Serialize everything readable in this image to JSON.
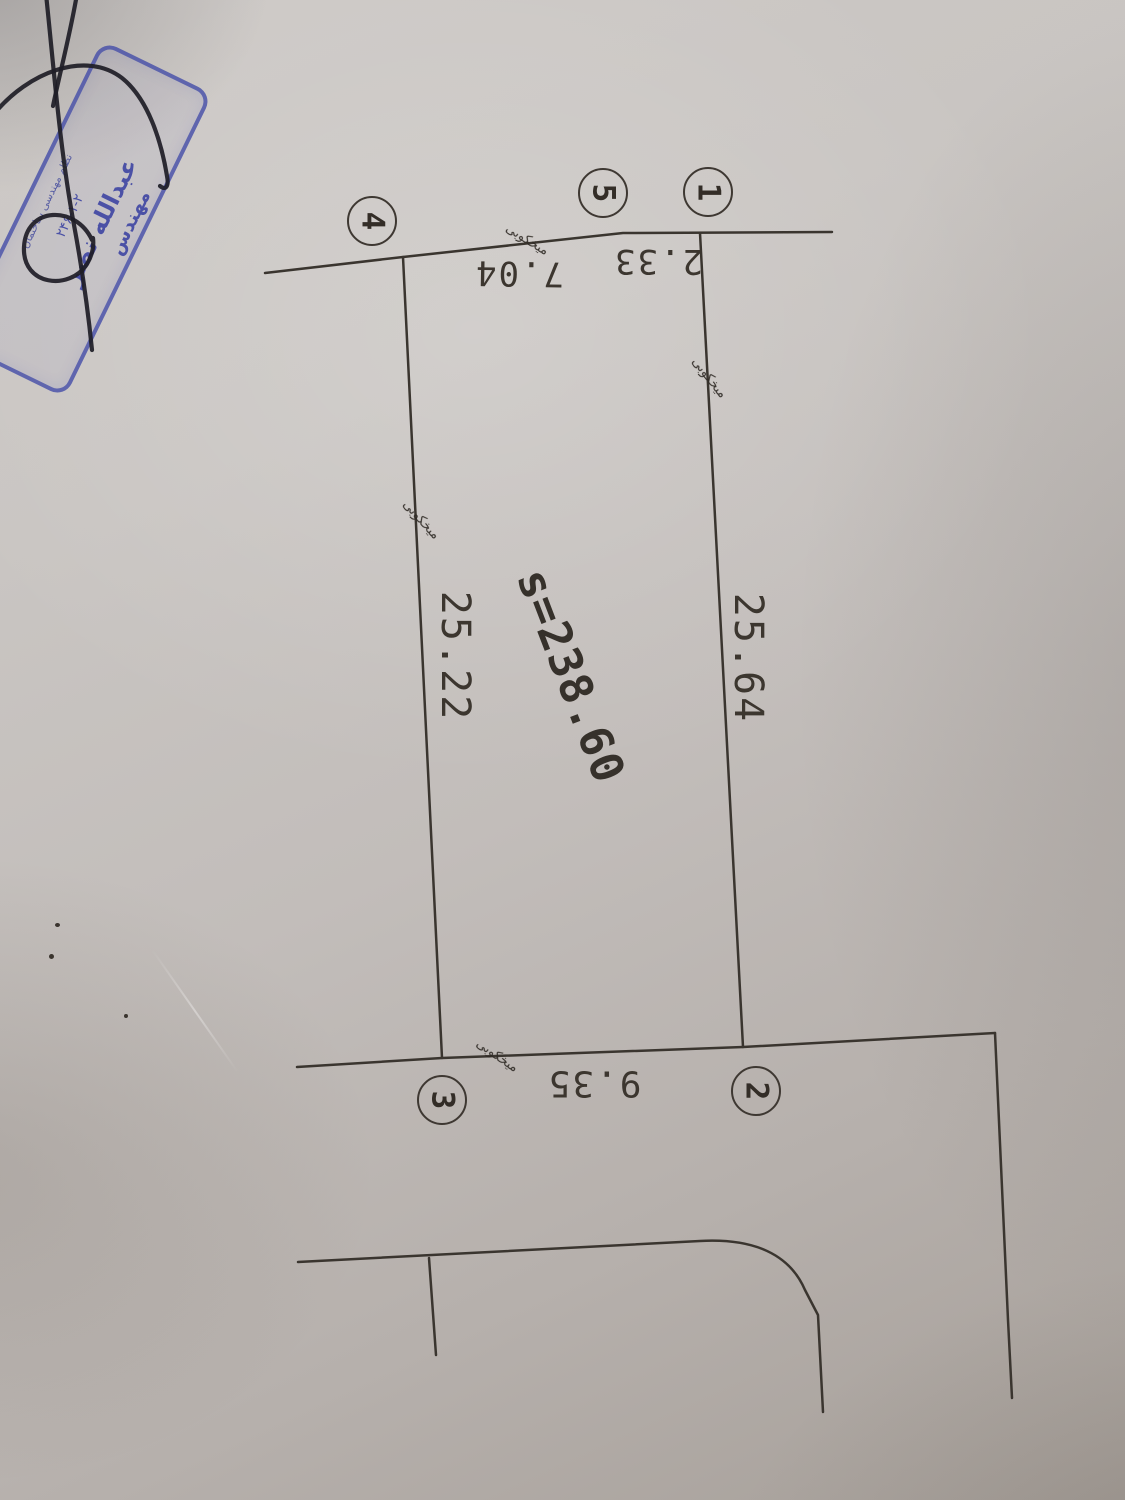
{
  "stamp": {
    "org_line": "نظام مهندسی ساختمان",
    "license_line": "۲۴۶-۱-۲",
    "name_line": "عبدالله نصر",
    "title_line": "مهندس",
    "color": "#4b51a6"
  },
  "plot": {
    "area_label": "s=238.60",
    "point_labels": [
      "1",
      "2",
      "3",
      "4",
      "5"
    ],
    "dimensions": {
      "right_side": "25.64",
      "left_side": "25.22",
      "top_seg_1_5": "2.33",
      "top_seg_5_4": "7.04",
      "bottom_seg_3_2": "9.35"
    },
    "annotation_text": "میخکوبی"
  },
  "colors": {
    "paper": "#c6c1bd",
    "drawing_line": "#3a352f",
    "signature_ink": "#1e1d26",
    "stamp_blue": "#4b51a6"
  }
}
